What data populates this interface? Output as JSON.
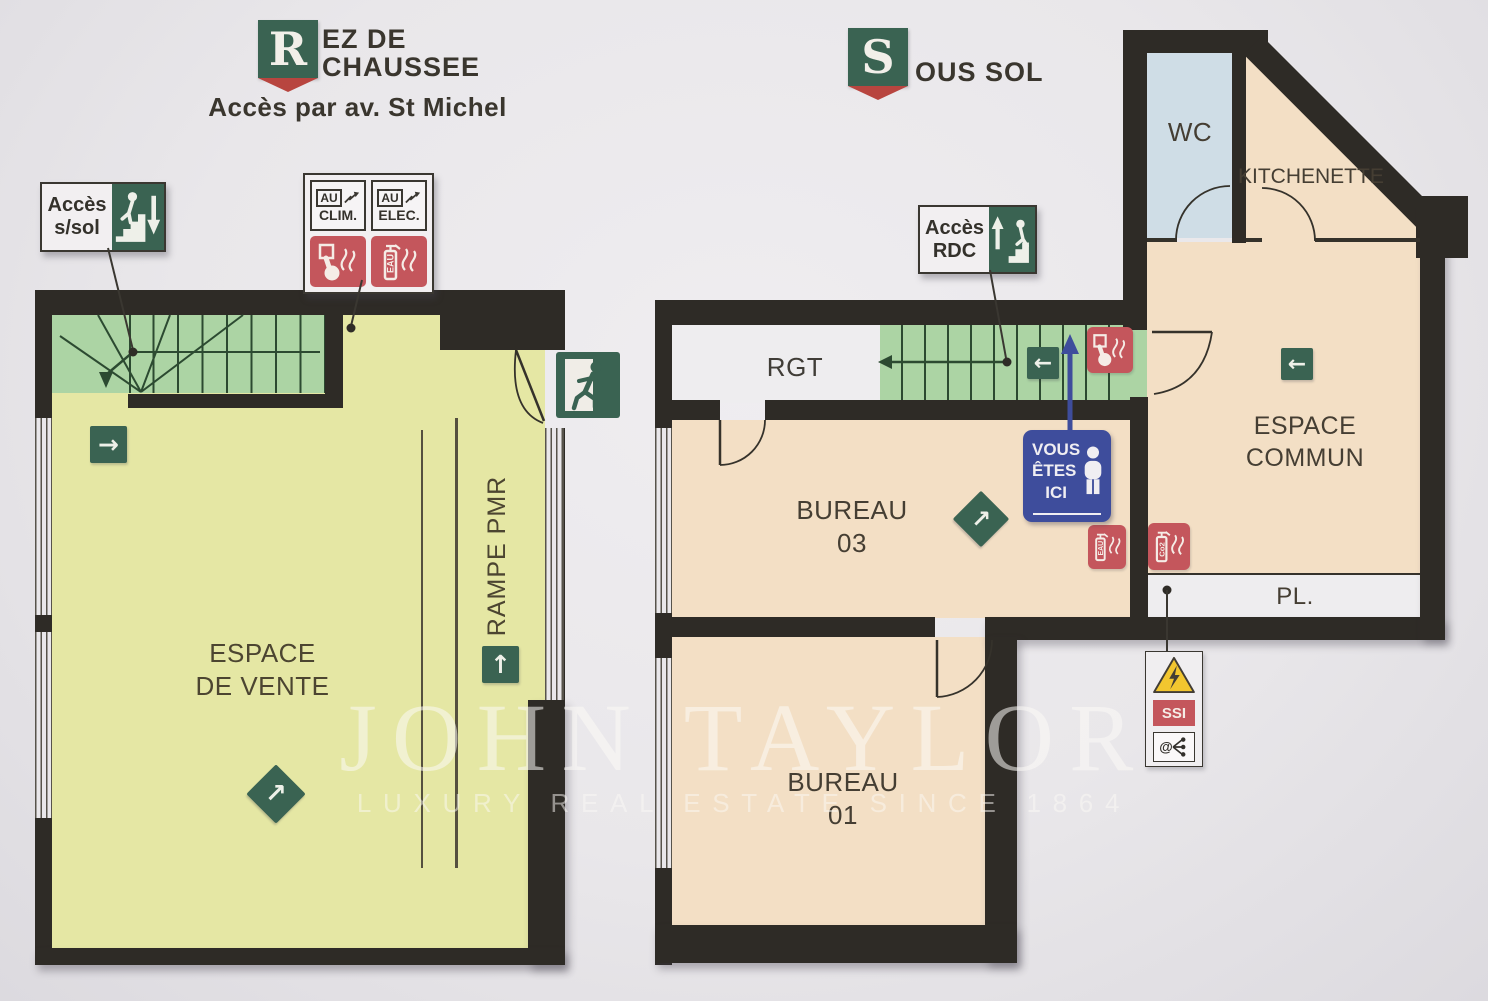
{
  "watermark": {
    "brand": "JOHN TAYLOR",
    "tagline": "LUXURY REAL ESTATE SINCE 1864"
  },
  "colors": {
    "wall": "#2e2b26",
    "floor_ground": "#e5e7a4",
    "stairs": "#acd4a4",
    "floor_basement": "#f3dfc5",
    "wc": "#cfdde6",
    "sign_green": "#3a6352",
    "sign_red": "#c4565c",
    "sign_blue": "#3e4d9c",
    "warning_yellow": "#f2c62f"
  },
  "icons": {
    "arrow_right": "→",
    "arrow_left": "←",
    "arrow_up": "↑",
    "arrow_up_right": "↗",
    "at_sign": "@"
  },
  "ground_floor": {
    "badge_letter": "R",
    "title_line1": "EZ DE",
    "title_line2": "CHAUSSEE",
    "access_note": "Accès par av. St Michel",
    "sign_access_basement": {
      "line1": "Accès",
      "line2": "s/sol"
    },
    "sign_shutoffs": {
      "clim_box": "AU",
      "clim": "CLIM.",
      "elec_box": "AU",
      "elec": "ELEC.",
      "extinguisher_label": "EAU"
    },
    "room_sales_line1": "ESPACE",
    "room_sales_line2": "DE VENTE",
    "ramp_label": "RAMPE PMR"
  },
  "basement": {
    "badge_letter": "S",
    "title": "OUS SOL",
    "sign_access_ground": {
      "line1": "Accès",
      "line2": "RDC"
    },
    "sign_you_are_here": {
      "line1": "VOUS",
      "line2": "ÊTES",
      "line3": "ICI"
    },
    "rooms": {
      "wc": "WC",
      "kitchenette": "KITCHENETTE",
      "storage": "RGT",
      "office3_name": "BUREAU",
      "office3_num": "03",
      "office1_name": "BUREAU",
      "office1_num": "01",
      "common_line1": "ESPACE",
      "common_line2": "COMMUN",
      "closet": "PL."
    },
    "extinguisher_water": "EAU",
    "extinguisher_co2": "Co2",
    "ssi_label": "SSI"
  }
}
